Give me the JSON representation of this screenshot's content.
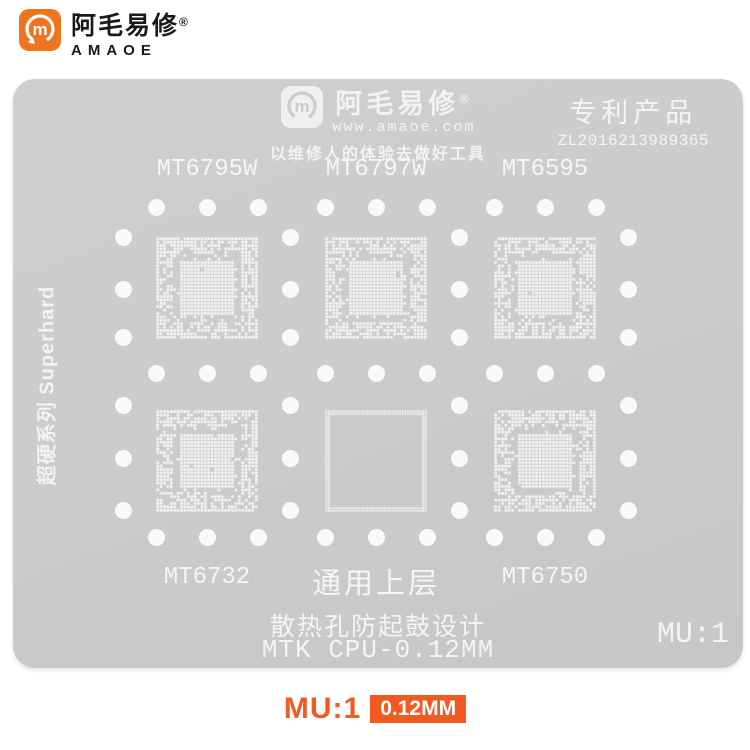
{
  "header": {
    "brand_cn": "阿毛易修",
    "reg_mark": "®",
    "brand_en": "AMAOE",
    "logo_color": "#ee7420"
  },
  "stencil": {
    "plate_color": "#cbcbcb",
    "hole_color": "#f9f9f9",
    "watermark": {
      "brand_cn": "阿毛易修",
      "reg_mark": "®",
      "url": "www.amaoe.com",
      "slogan": "以维修人的体验去做好工具"
    },
    "patent": {
      "title": "专利产品",
      "number": "ZL2016213989365"
    },
    "side_label": "超硬系列 Superhard",
    "chips": [
      {
        "label": "MT6795W",
        "type": "bga",
        "row": 0,
        "col": 0,
        "seed": 101
      },
      {
        "label": "MT6797W",
        "type": "bga",
        "row": 0,
        "col": 1,
        "seed": 202
      },
      {
        "label": "MT6595",
        "type": "bga",
        "row": 0,
        "col": 2,
        "seed": 303
      },
      {
        "label": "MT6732",
        "type": "bga",
        "row": 1,
        "col": 0,
        "seed": 404
      },
      {
        "label": "通用上层",
        "type": "frame",
        "row": 1,
        "col": 1,
        "seed": 505
      },
      {
        "label": "MT6750",
        "type": "bga",
        "row": 1,
        "col": 2,
        "seed": 606
      }
    ],
    "notes": {
      "line1": "散热孔防起鼓设计",
      "line2": "MTK CPU-0.12MM"
    },
    "model_code": "MU:1"
  },
  "footer": {
    "model_code": "MU:1",
    "thickness_badge": "0.12MM",
    "accent_color": "#f15b22"
  }
}
